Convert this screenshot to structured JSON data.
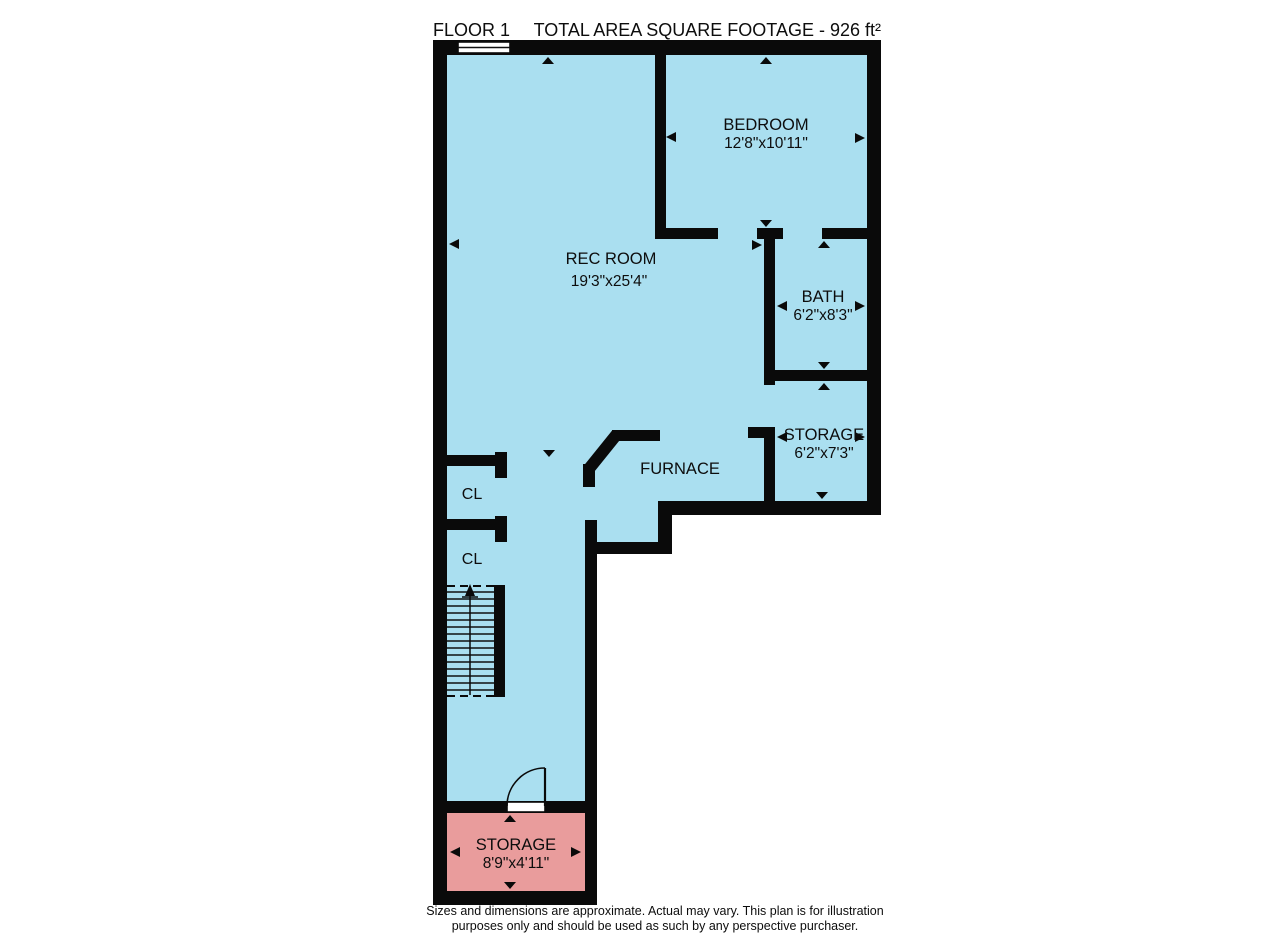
{
  "header": {
    "floor_label": "FLOOR 1",
    "total_area_label": "TOTAL AREA SQUARE FOOTAGE - 926 ft²"
  },
  "rooms": {
    "bedroom": {
      "name": "BEDROOM",
      "dims": "12'8\"x10'11\""
    },
    "rec_room": {
      "name": "REC ROOM",
      "dims": "19'3\"x25'4\""
    },
    "bath": {
      "name": "BATH",
      "dims": "6'2\"x8'3\""
    },
    "storage": {
      "name": "STORAGE",
      "dims": "6'2\"x7'3\""
    },
    "furnace": {
      "name": "FURNACE"
    },
    "closet_upper": {
      "name": "CL"
    },
    "closet_lower": {
      "name": "CL"
    },
    "basement_storage": {
      "name": "STORAGE",
      "dims": "8'9\"x4'11\""
    }
  },
  "footer": {
    "line1": "Sizes and dimensions are approximate. Actual may vary. This plan is for illustration",
    "line2": "purposes only and should be used as such by any perspective purchaser."
  },
  "colors": {
    "floor": "#aadff0",
    "storage_floor": "#e99c9c",
    "wall": "#0a0a0a"
  }
}
